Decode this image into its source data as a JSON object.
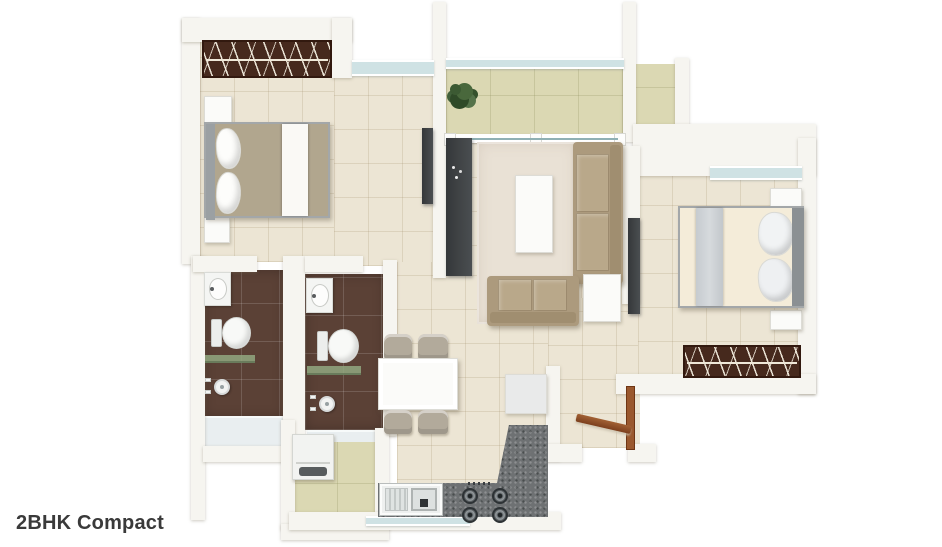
{
  "caption": {
    "title": "2BHK Compact"
  },
  "colors": {
    "wall": "#f6f5f0",
    "floor": "#ece5d4",
    "balcony": "#dbd8b3",
    "bath": "#5b4136",
    "wood": "#46291d",
    "granite": "#6e7173",
    "sofa": "#ac9a7d",
    "cushion": "#b9a88a",
    "glass": "#cfe2e4",
    "door": "#9a582e",
    "dark": "#3e4143",
    "rug": "#e9e1d5",
    "blanket": "#b1a68e",
    "text": "#3a3a3a"
  }
}
